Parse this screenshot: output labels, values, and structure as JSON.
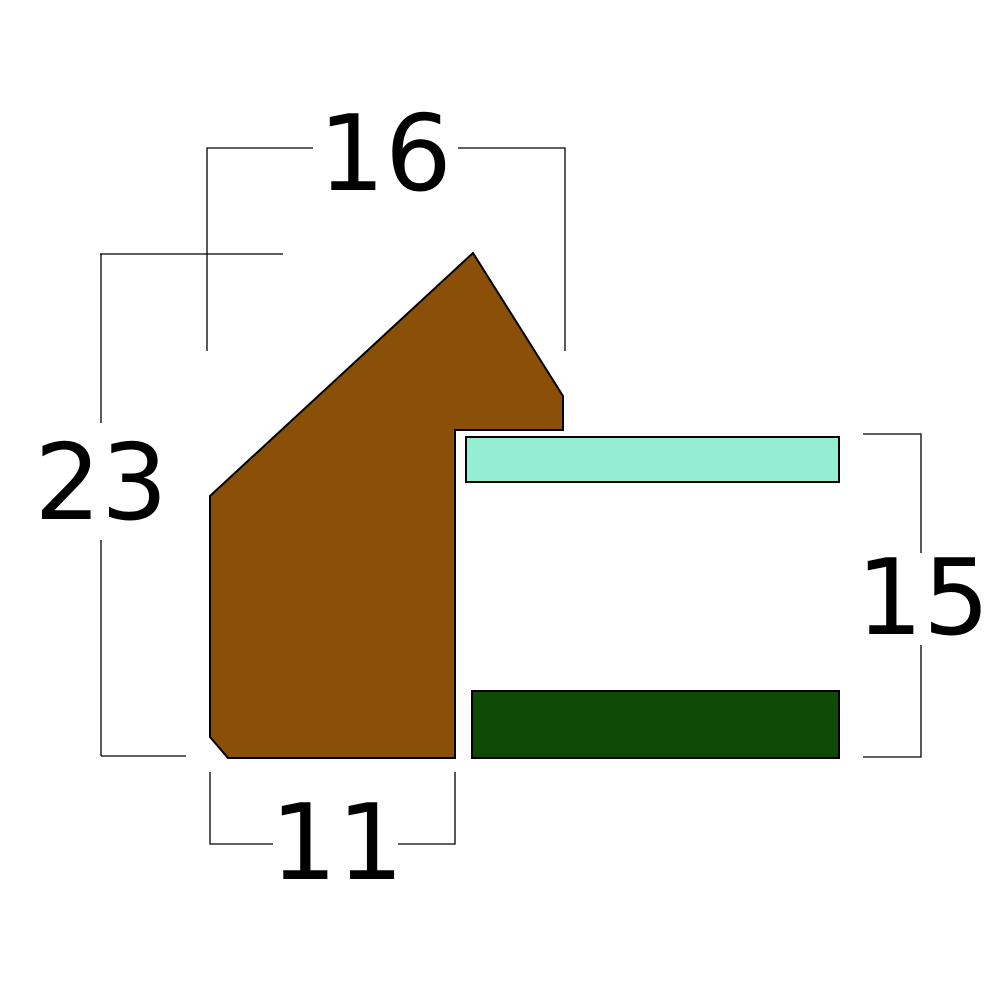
{
  "canvas": {
    "width": 1000,
    "height": 1000,
    "background": "#ffffff",
    "line_color": "#000000"
  },
  "shapes": {
    "moulding": {
      "points": "210,496 473,253 563,396 563,430 455,430 455,758 228,758 210,737",
      "fill": "#8A5008"
    },
    "glass_strip": {
      "x": "466",
      "y": "437",
      "width": "373",
      "height": "45",
      "fill": "#96EED2"
    },
    "backing_strip": {
      "x": "472",
      "y": "691",
      "width": "367",
      "height": "67",
      "fill": "#0E4A06"
    }
  },
  "dimensions": {
    "width_top": {
      "label": "16",
      "value": 16,
      "path": "M 207 351 L 207 148 L 313 148 M 458 148 L 565 148 L 565 351",
      "label_x": "385",
      "label_y": "190"
    },
    "height_left": {
      "label": "23",
      "value": 23,
      "path": "M 100 254 L 283 254 M 101 254 L 101 423 M 101 540 L 101 756 M 101 756 L 186 756",
      "label_x": "101",
      "label_y": "519"
    },
    "width_bottom": {
      "label": "11",
      "value": 11,
      "path": "M 210 772 L 210 844 L 273 844 M 398 844 L 455 844 L 455 772",
      "label_x": "337",
      "label_y": "879"
    },
    "height_right": {
      "label": "15",
      "value": 15,
      "path": "M 863 434 L 921 434 L 921 553 M 921 645 L 921 757 L 863 757",
      "label_x": "923",
      "label_y": "634"
    }
  }
}
